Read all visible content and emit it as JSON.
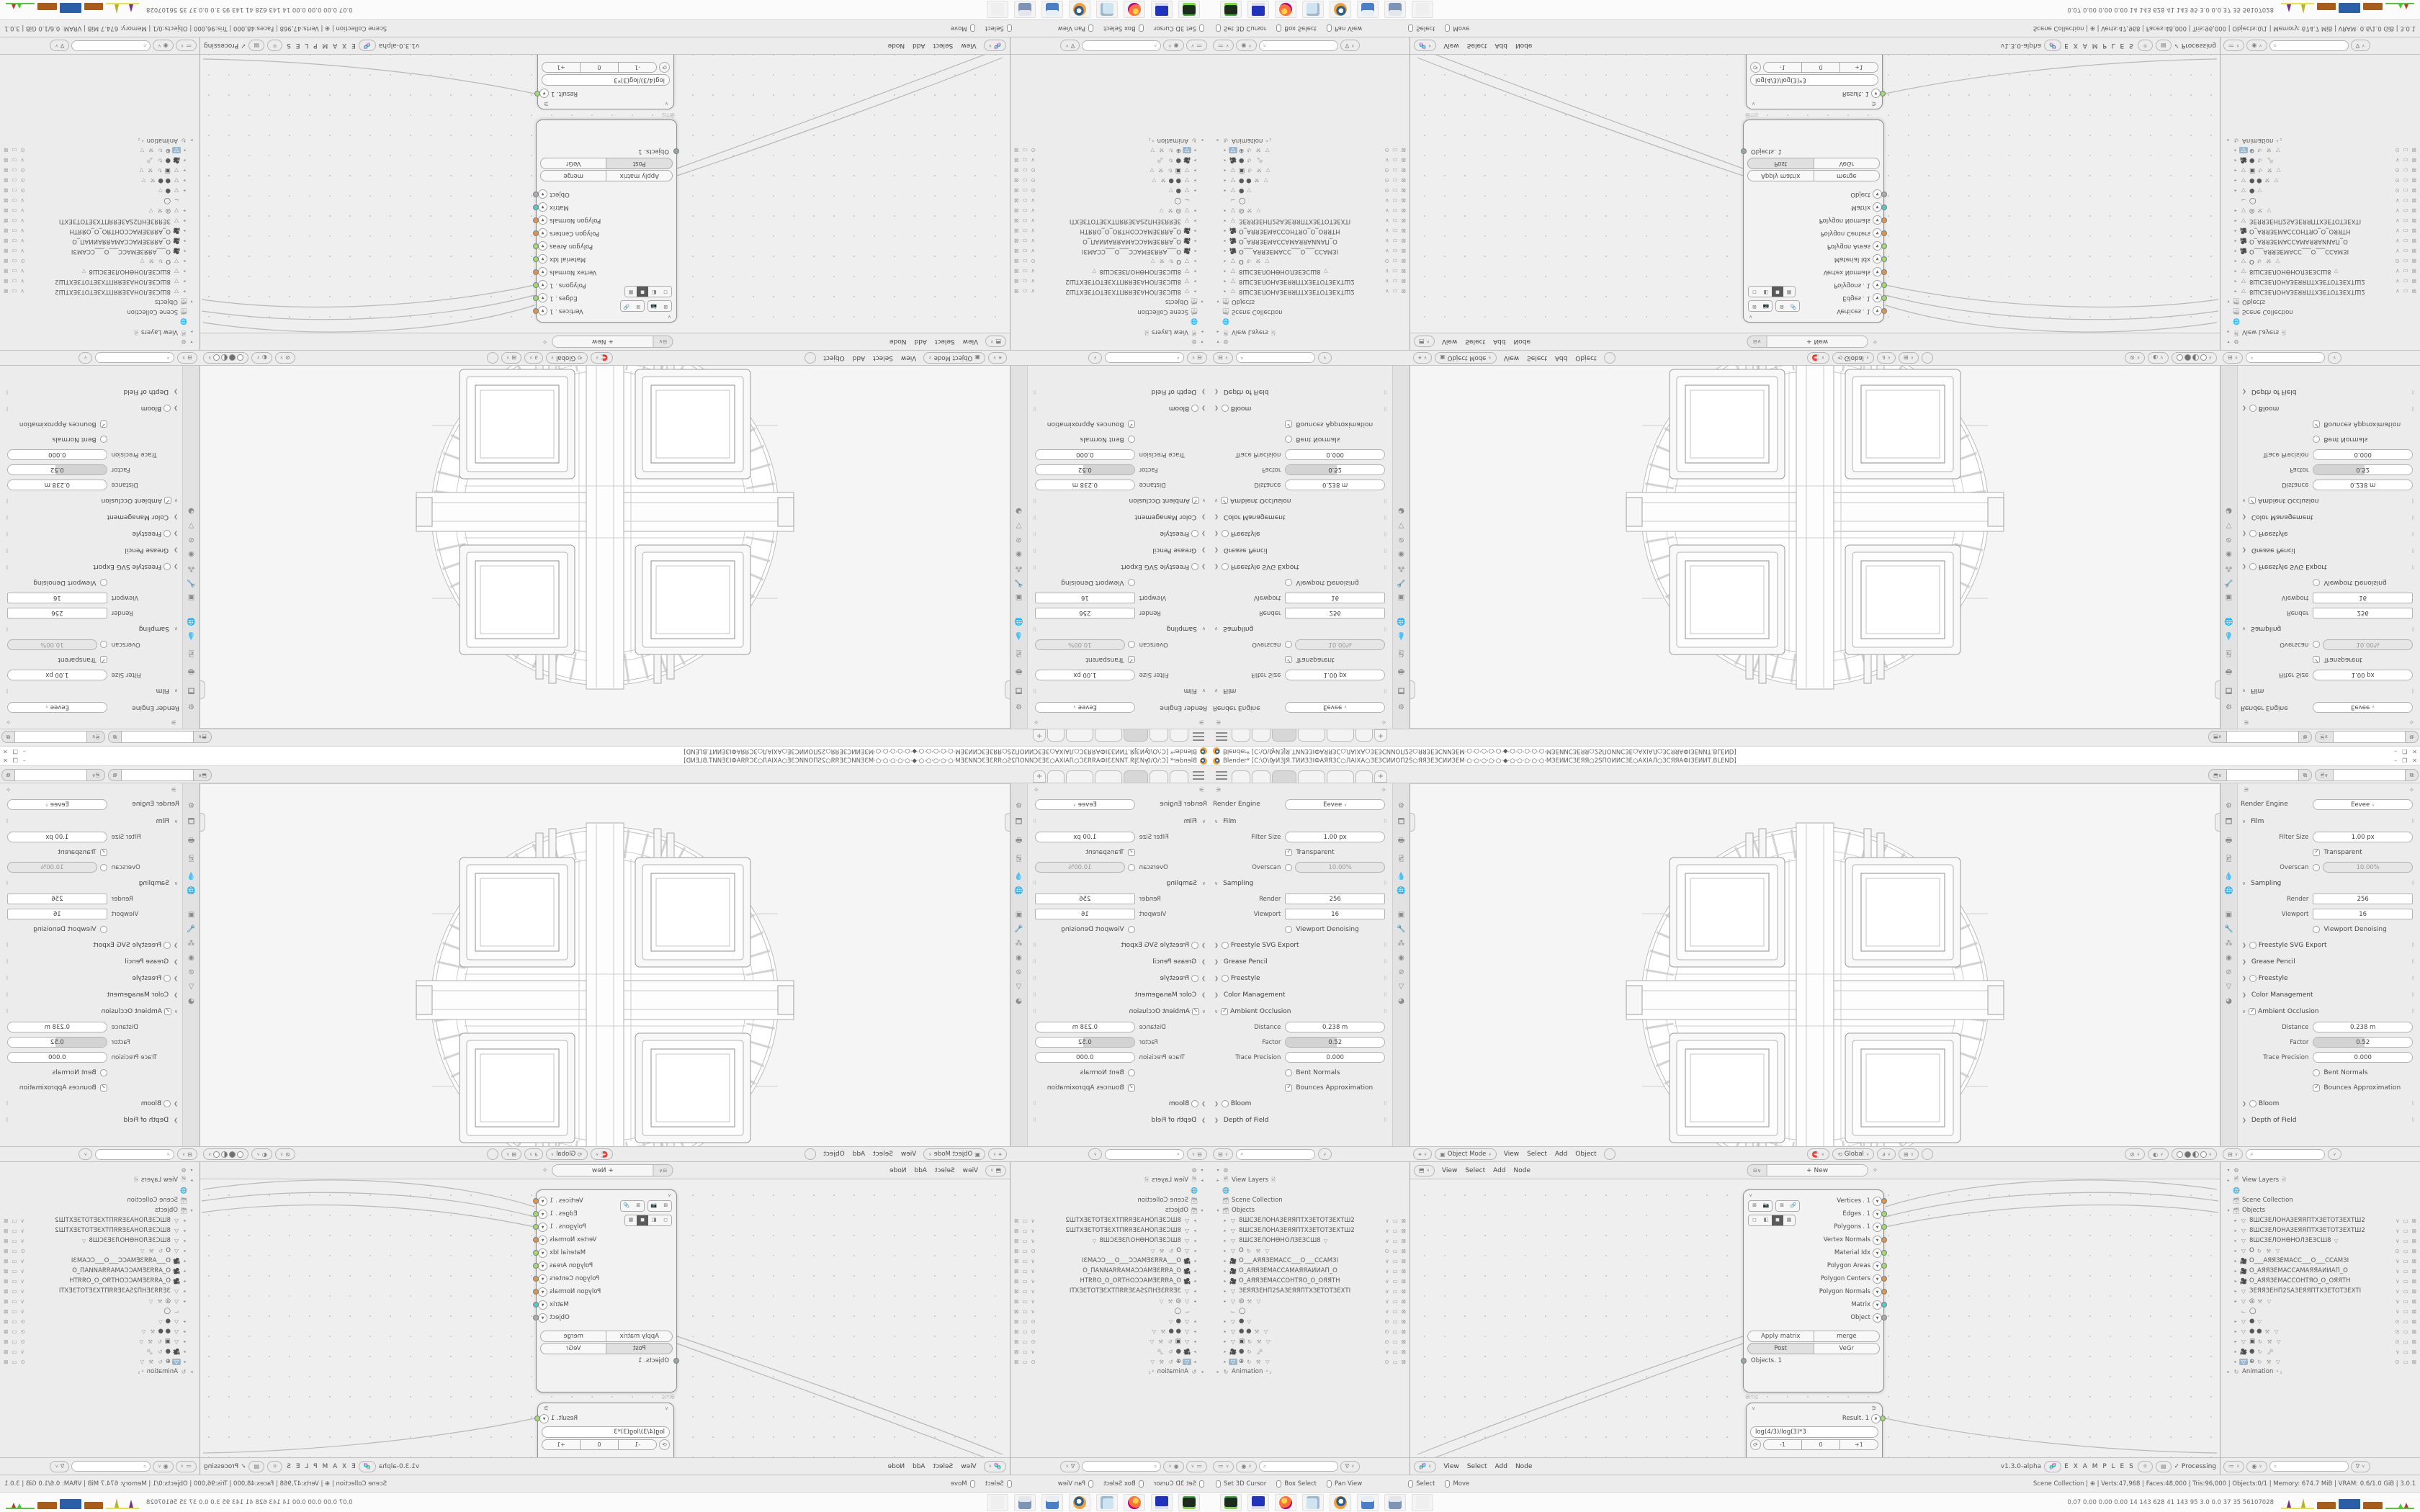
{
  "window": {
    "title": "Blender* [C:\\О\\ѸИЗЈЯ.ТИИЗЗІФАЯЯЗС○ЛАІХА○ЗЕЗСИИОП2Ѕ○ЯЯЗЕЗСИИЗЕМ·○·○·○·○·○·◆·○·○·○·○·○·МЗЕИИСЗЕЯЯ○2ЅПОИИСЗЕ○АХІАЛ○ЗСЯЯАФІЗЕИИТ.BLEND]",
    "buttons": {
      "minimize": "–",
      "maximize": "❐",
      "close": "✕"
    }
  },
  "topbar": {
    "tabs": [
      {
        "w": 26
      },
      {
        "w": 26
      },
      {
        "w": 34,
        "active": true
      },
      {
        "w": 38
      },
      {
        "w": 38
      },
      {
        "w": 24
      }
    ],
    "plus": "+",
    "id_selectors": [
      {
        "icon": "⬒",
        "copy": "⧉"
      },
      {
        "icon": "🖻",
        "copy": "⧉"
      }
    ]
  },
  "properties": {
    "pin_icon": "✧",
    "tool_icon": "⚞",
    "nav_icons": [
      "⚙",
      "🗖",
      "🖶",
      "🖻",
      "💧",
      "🌐",
      "",
      "▣",
      "🔧",
      "⁂",
      "◉",
      "⊘",
      "▽",
      "◕"
    ],
    "engine_label": "Render Engine",
    "engine_value": "Eevee",
    "rows": [
      {
        "k": "section",
        "label": "Film",
        "open": true
      },
      {
        "k": "field",
        "label": "Filter Size",
        "value": "1.00 px"
      },
      {
        "k": "check",
        "label": "Transparent",
        "checked": true
      },
      {
        "k": "togglefield",
        "label": "Overscan",
        "value": "10.00%",
        "checked": false
      },
      {
        "k": "section",
        "label": "Sampling",
        "open": true
      },
      {
        "k": "fieldsq",
        "label": "Render",
        "value": "256"
      },
      {
        "k": "fieldsq",
        "label": "Viewport",
        "value": "16"
      },
      {
        "k": "check",
        "label": "Viewport Denoising",
        "checked": false
      },
      {
        "k": "collapsed",
        "label": "Freestyle SVG Export",
        "check": true
      },
      {
        "k": "collapsed",
        "label": "Grease Pencil"
      },
      {
        "k": "collapsed",
        "label": "Freestyle",
        "check": true
      },
      {
        "k": "collapsed",
        "label": "Color Management"
      },
      {
        "k": "sectioncheck",
        "label": "Ambient Occlusion",
        "checked": true
      },
      {
        "k": "field",
        "label": "Distance",
        "value": "0.238 m"
      },
      {
        "k": "slider",
        "label": "Factor",
        "value": "0.52",
        "frac": 0.52
      },
      {
        "k": "field",
        "label": "Trace Precision",
        "value": "0.000"
      },
      {
        "k": "check",
        "label": "Bent Normals",
        "checked": false
      },
      {
        "k": "check",
        "label": "Bounces Approximation",
        "checked": true
      },
      {
        "k": "collapsed",
        "label": "Bloom",
        "check": true
      },
      {
        "k": "collapsed",
        "label": "Depth of Field"
      }
    ]
  },
  "viewport_header": {
    "mode_icon": "▣",
    "mode": "Object Mode",
    "menus": [
      "View",
      "Select",
      "Add",
      "Object"
    ],
    "transform_label": "Global",
    "mid_icons": [
      "🧲",
      "∂",
      "⊞"
    ],
    "right_icons": [
      "⊘",
      "◐"
    ]
  },
  "node_editor": {
    "header_icon": "⬒",
    "footer_icon": "🧬",
    "menus": [
      "View",
      "Select",
      "Add",
      "Node"
    ],
    "new_button": "+        New",
    "version": "v1.3.0-alpha",
    "brand": "E X A M P L E S",
    "processing": "✓  Processing",
    "objects_node": {
      "outputs": [
        {
          "label": "Vertices",
          "suffix": ". 1",
          "menu": true,
          "color": "#dd9552"
        },
        {
          "label": "Edges",
          "suffix": ". 1",
          "menu": true,
          "color": "#9fdc72"
        },
        {
          "label": "Polygons",
          "suffix": ". 1",
          "menu": true,
          "color": "#9fdc72"
        },
        {
          "label": "Vertex Normals",
          "suffix": "",
          "menu": true,
          "color": "#dd9552"
        },
        {
          "label": "Material Idx",
          "suffix": "",
          "menu": true,
          "color": "#9fdc72"
        },
        {
          "label": "Polygon Areas",
          "suffix": "",
          "menu": true,
          "color": "#9fdc72"
        },
        {
          "label": "Polygon Centers",
          "suffix": "",
          "menu": true,
          "color": "#dd9552"
        },
        {
          "label": "Polygon Normals",
          "suffix": "",
          "menu": true,
          "color": "#dd9552"
        },
        {
          "label": "Matrix",
          "suffix": "",
          "menu": true,
          "color": "#57c8c2"
        },
        {
          "label": "Object",
          "suffix": "",
          "menu": true,
          "color": "#ababab"
        }
      ],
      "buttons": [
        [
          "Apply matrix",
          "merge"
        ],
        [
          "Post",
          "VeGr"
        ]
      ],
      "pressed": "Post",
      "left_output": "Objects. 1",
      "left_output_color": "#9aa5a5",
      "timing": "0ms"
    },
    "number_node": {
      "result_label": "Result. 1",
      "result_color": "#9fdc72",
      "formula": "log(4/3)/log(3)*3",
      "cycle_icon": "⟳",
      "buttons": [
        "-1",
        "0",
        "+1"
      ]
    }
  },
  "outliner": {
    "header_icon": "⊟",
    "scene_rows": [
      {
        "tw": "▾",
        "icon": "⚙",
        "name": ""
      },
      {
        "tw": "▸",
        "icon": "🖻",
        "name": "View Layers",
        "after": "🖻"
      },
      {
        "tw": "",
        "icon": "🌐",
        "name": ""
      },
      {
        "tw": "",
        "icon": "🗃",
        "name": "Scene Collection"
      },
      {
        "tw": "▾",
        "icon": "🗃",
        "name": "Objects"
      }
    ],
    "object_rows": [
      {
        "icon": "▽",
        "name": "8ШСЗЕЛОНАЗЕЯЯПТХЗЕТОТЗЕХТШ2",
        "eye": "∨"
      },
      {
        "icon": "▽",
        "name": "8ШСЗЕЛОНАЗЕЯЯПТХЗЕТОТЗЕХТШ2",
        "eye": "∨"
      },
      {
        "icon": "▽",
        "name": "8ШСЗЕЛОНѲНОЛЗЕЗСШ8",
        "extras": "▽",
        "eye": "∨"
      },
      {
        "icon": "▽",
        "name": "O",
        "extras": "↻ ⚒ ▽",
        "eye": "⊙"
      },
      {
        "icon": "🎥",
        "name": "О___АЯЯЗЕМАСС___О___ССАМЗІ",
        "eye": "∨"
      },
      {
        "icon": "🎥",
        "name": "О_АЯЯЗЕМАССАМАЯЯАИИАП_О",
        "eye": "∨"
      },
      {
        "icon": "🎥",
        "name": "О_АЯЯЗЕМАССОНТЯО_О_ОЯЯТН",
        "eye": "∨"
      },
      {
        "icon": "▽",
        "name": "ЗЕЯЯЗЕНП2ЅАЗЕЯЯПТХЗЕТОТЗЕХТІ",
        "eye": "∨"
      },
      {
        "icon": "▽",
        "name": "◎",
        "extras": "⚒ ▽",
        "eye": "∨"
      },
      {
        "icon": "⌙",
        "name": "◯",
        "eye": "∨",
        "noarrow": true
      },
      {
        "icon": "▽",
        "name": "●",
        "extras": "▽",
        "eye": "⊙"
      },
      {
        "icon": "▽",
        "name": "● ●",
        "extras": "⚒ ▽",
        "eye": "⊙"
      },
      {
        "icon": "▽",
        "name": "▣",
        "extras": "↻ ⚒ ▽",
        "eye": "⊙"
      },
      {
        "icon": "🎥",
        "name": "●",
        "extras": "↻ 🗝",
        "eye": "∨"
      },
      {
        "icon": "▽",
        "name": "⊕",
        "extras": "↻ ⚒ ▽",
        "eye": "⊙",
        "active": true
      }
    ],
    "animation_row": {
      "tw": "▸",
      "icon": "↻",
      "name": "Animation",
      "after": "⁴₂"
    },
    "filter_icons": [
      "≔",
      "◉"
    ],
    "filter_funnel": "∇"
  },
  "statusbar": {
    "hints_left": [
      {
        "label": "Set 3D Cursor"
      },
      {
        "label": "Box Select"
      },
      {
        "label": "Pan View"
      }
    ],
    "hints_mid": [
      {
        "label": "Select"
      },
      {
        "label": "Move"
      }
    ],
    "stats": "Scene Collection  |  ⊕  |  Verts:47,968 | Faces:48,000 | Tris:96,000 | Objects:0/1 | Memory: 674.7 MiB | VRAM: 0.6/1.0 GiB | 3.0.1"
  },
  "taskbar": {
    "apps": [
      "terminal",
      "dosbox",
      "firefox",
      "notepad",
      "blender",
      "calculator",
      "calculator-alt",
      "ghost"
    ],
    "stats": "0.07 0.00 0.00 0.00   14   143   628   41   143   95   3.0   0.0   37   35  56107028"
  }
}
